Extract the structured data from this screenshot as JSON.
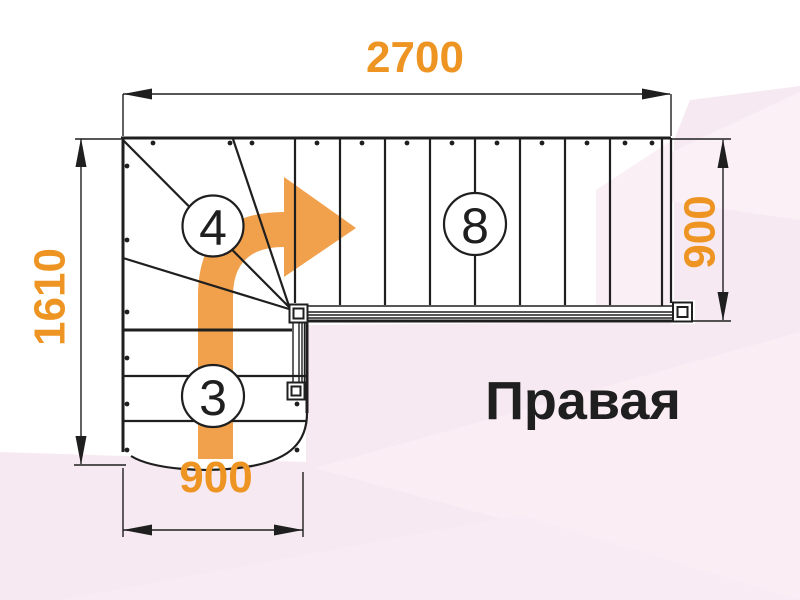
{
  "diagram_type": "stair-plan",
  "dimensions": {
    "top": "2700",
    "left": "1610",
    "right": "900",
    "bottom": "900"
  },
  "step_counts": {
    "winder": "4",
    "upper_flight": "8",
    "lower_flight": "3"
  },
  "direction_label": "Правая",
  "colors": {
    "dimension_text": "#ED9422",
    "arrow": "#F1A04C",
    "line": "#1F1F1F",
    "background_pink": "#F7E9F1"
  }
}
